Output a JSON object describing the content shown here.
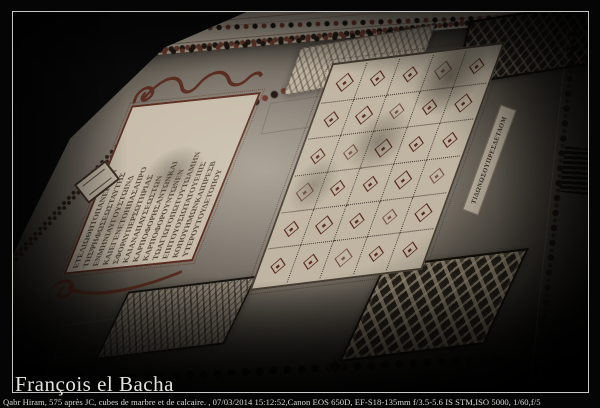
{
  "frame": {
    "watermark": "François el Bacha",
    "caption": "Qabr Hiram, 575 après JC, cubes de marbre et de calcaire. , 07/03/2014 15:12:52,Canon EOS 650D, EF-S18-135mm f/3.5-5.6 IS STM,ISO 5000, 1/60,f/5"
  },
  "photo": {
    "colors": {
      "frame_line": "#c7c7c3",
      "mosaic_cream": "#c7bcaa",
      "motif_maroon": "#5a2c20",
      "dark_tesserae": "#221e19",
      "text_dark": "#43332a"
    },
    "inscription_panel": {
      "columns": [
        "ΕΤΕΛΙΩΘΗΤΟΠΑΝΕΡΓΟΝ",
        "ΤΗΣΨΗΦΩΣΕΩΣΤΑΥΤΗΣ",
        "ΕΝΜΗΝΙΑΥΓΟΥΣΤΩΙΝΔ",
        "ΚΑΙΕΓΕΝΕΤΟΗΠΑΣΑΠΡΟ",
        "ΣΦΟΡΑΥΠΕΡΣΩΤΗΡΙΑΣ",
        "ΚΑΙΑΝΑΠΑΥΣΕΩΣΤΩΝ",
        "ΚΑΡΠΟΦΟΡΗΣΑΝΤΩΝΚΑΙ",
        "ΚΑΡΠΟΦΟΡΟΥΝΤΩΝΕΝ",
        "ΤΩΑΓΙΩΤΟΠΩΤΟΥΤΩΑΜΗΝ",
        "ΕΠΙΤΟΥΟΣΙΩΤΑΤΟΥΕΠΙΣ",
        "ΚΟΠΟΥΗΜΩΝΚΑΙΠΡΕΣΒ",
        "ΥΤΕΡΟΥΤΟΥΔΕΤΟΠΟΥ"
      ]
    },
    "side_inscription": "ΤΙΔΩΝΩΣΟΥΠΡΕΣΔΕΤΑΟΜ",
    "grid": {
      "cols": 5,
      "rows": 6
    }
  }
}
